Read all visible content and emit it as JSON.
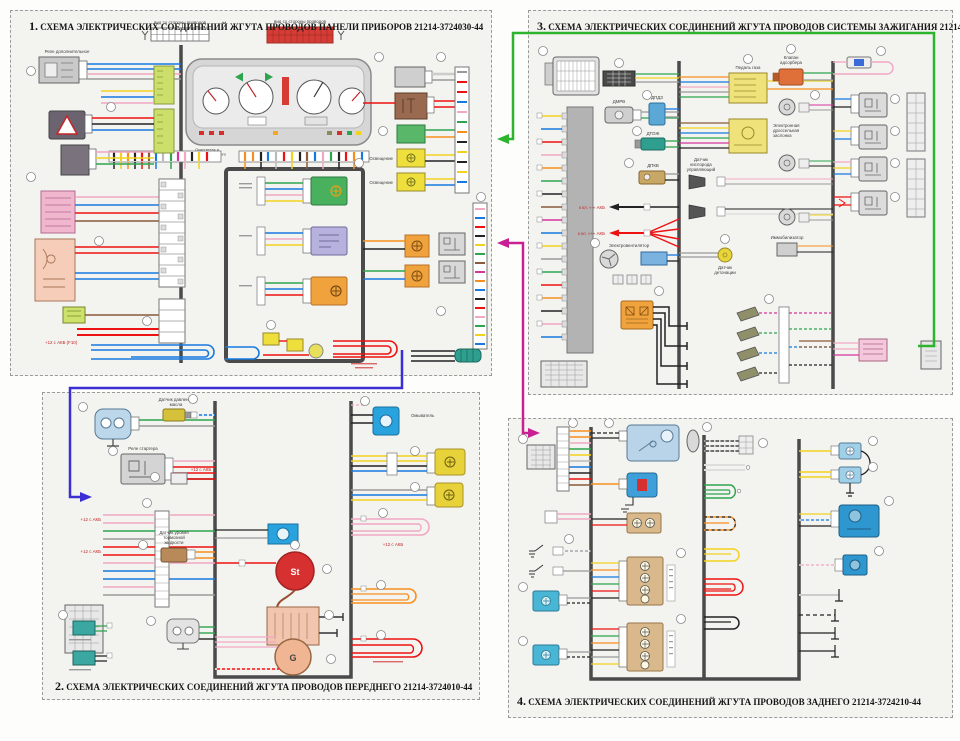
{
  "page": {
    "background": "#fdfdfb",
    "panel_background": "#f3f3f0"
  },
  "colors": {
    "link_green": "#2db32d",
    "link_blue": "#3b2fd4",
    "link_magenta": "#c92093",
    "trunk": "#4a4a4a"
  },
  "panels": {
    "panel1": {
      "num": "1.",
      "title": "СХЕМА ЭЛЕКТРИЧЕСКИХ СОЕДИНЕНИЙ  ЖГУТА ПРОВОДОВ ПАНЕЛИ ПРИБОРОВ  21214-3724030-44",
      "labels": {
        "relay_aux": "Реле дополнительное",
        "view_left": "вид со стороны проводов",
        "view_right": "вид со стороны проводов",
        "wiper": [
          "Очиститель и",
          "омыватель ветрового",
          "стекла"
        ],
        "plus12": "+12 с АКБ (F10)",
        "light1": "Освещение",
        "light2": "Освещение"
      }
    },
    "panel2": {
      "num": "2.",
      "title": "СХЕМА ЭЛЕКТРИЧЕСКИХ СОЕДИНЕНИЙ ЖГУТА ПРОВОДОВ ПЕРЕДНЕГО  21214-3724010-44",
      "labels": {
        "starter_relay": "Реле стартера",
        "oil_sensor": [
          "Датчик давления",
          "масла"
        ],
        "brake_fluid": [
          "Датчик уровня",
          "тормозной",
          "жидкости"
        ],
        "washer": "Омыватель",
        "plus12": "+12 с АКБ",
        "starter": "St",
        "generator": "G"
      }
    },
    "panel3": {
      "num": "3.",
      "title": "СХЕМА ЭЛЕКТРИЧЕСКИХ СОЕДИНЕНИЙ ЖГУТА ПРОВОДОВ СИСТЕМЫ ЗАЖИГАНИЯ 21214-3724026-44",
      "labels": {
        "dmrv": "ДМРВ",
        "dpdz": "ДПДЗ",
        "dtozh": "ДТОЖ",
        "dpkv": "ДПКВ",
        "pedal": "Педаль газа",
        "adsorber": [
          "Клапан",
          "адсорбера"
        ],
        "o2": [
          "Датчик",
          "кислорода",
          "управляющий"
        ],
        "throttle": [
          "Электронная",
          "дроссельная",
          "заслонка"
        ],
        "immo": "Иммобилизатор",
        "knock": [
          "Датчик",
          "детонации"
        ],
        "fan": "Электровентилятор",
        "bat_plus": "к кл. «+» АКБ",
        "bat_minus": "к кл. «-» АКБ"
      }
    },
    "panel4": {
      "num": "4.",
      "title": "СХЕМА ЭЛЕКТРИЧЕСКИХ СОЕДИНЕНИЙ ЖГУТА ПРОВОДОВ ЗАДНЕГО 21214-3724210-44"
    }
  }
}
